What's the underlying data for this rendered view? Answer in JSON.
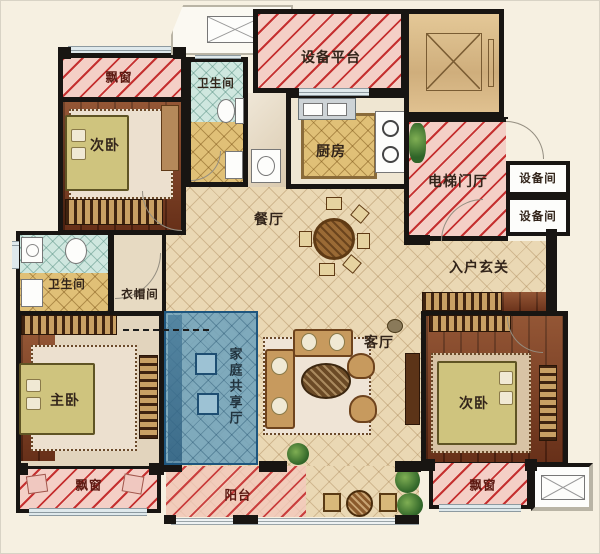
{
  "palette": {
    "background": "#f6f0e1",
    "wall": "#181512",
    "bay_fill": "#f4cfc6",
    "hatch_line": "#c53030",
    "floor_tile": "#ead8b4",
    "wood_floor": "#7c3c20",
    "kitchen_tile": "#e0c077",
    "bath_tile_blue": "#cfe7df",
    "family_hall_blue": "#6fa3bd",
    "family_hall_border": "#1e567e"
  },
  "rooms": {
    "bay_top_left": "飘窗",
    "bedroom_top_left": "次卧",
    "bath_top": "卫生间",
    "equipment_platform": "设备平台",
    "kitchen": "厨房",
    "elevator_hall": "电梯门厅",
    "equipment_room_upper": "设备间",
    "equipment_room_lower": "设备间",
    "dining": "餐厅",
    "foyer": "入户玄关",
    "bath_left": "卫生间",
    "cloakroom": "衣帽间",
    "family_hall": "家庭共享厅",
    "master_bedroom": "主卧",
    "living": "客厅",
    "bedroom_bottom_right": "次卧",
    "bay_bottom_left": "飘窗",
    "bay_bottom_right": "飘窗",
    "balcony": "阳台"
  }
}
